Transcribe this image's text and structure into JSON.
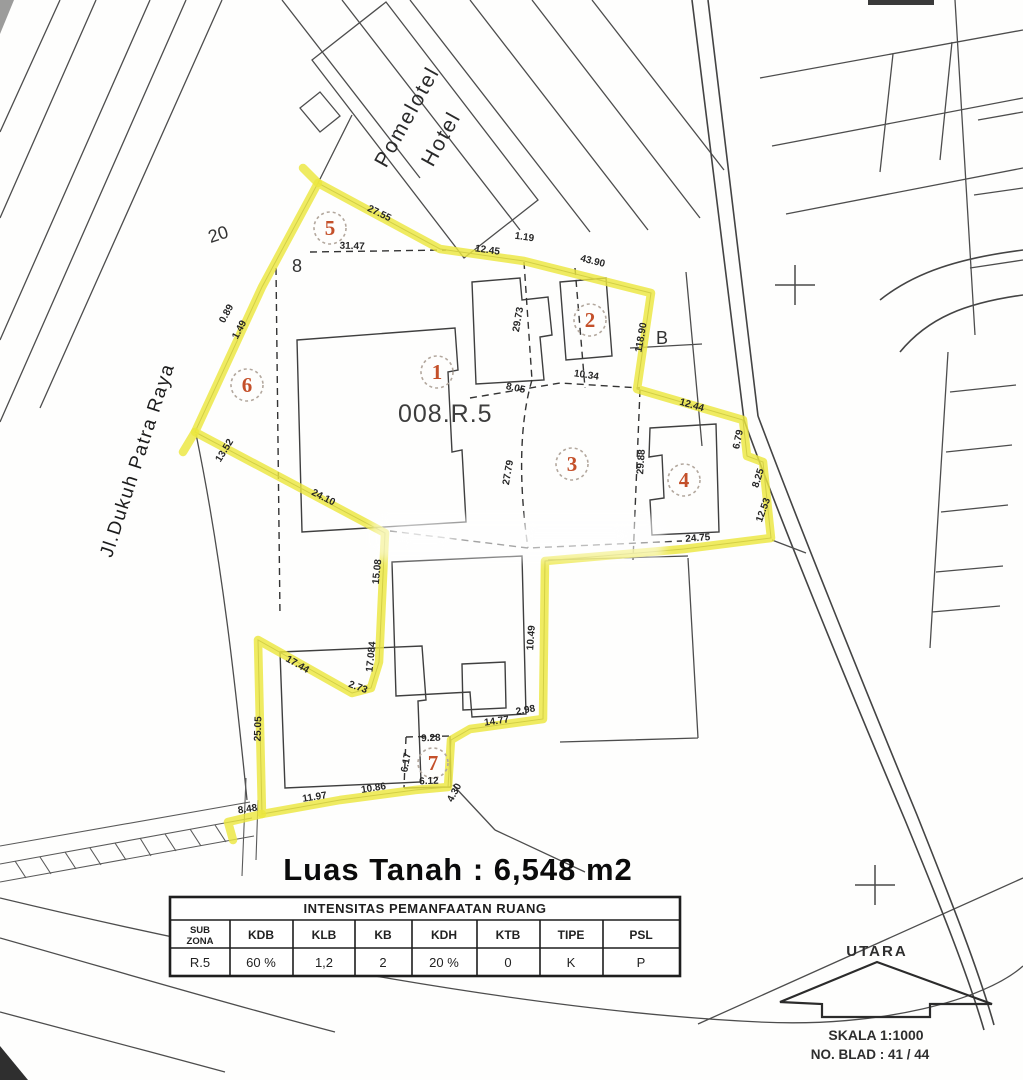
{
  "map": {
    "street_label": "Jl.Dukuh Patra Raya",
    "hotel_label_line1": "Pomelotel",
    "hotel_label_line2": "Hotel",
    "parcel_code": "008.R.5",
    "block_label": "B",
    "lot_number_20": "20",
    "lot_number_8": "8",
    "highlight_color": "#ece63e",
    "zone_number_color": "#c4502a",
    "zones": [
      "1",
      "2",
      "3",
      "4",
      "5",
      "6",
      "7"
    ],
    "dims": [
      "27.55",
      "31.47",
      "12.45",
      "1.19",
      "43.90",
      "118.90",
      "12.44",
      "6.79",
      "8.25",
      "12.53",
      "24.75",
      "29.88",
      "27.79",
      "8.05",
      "10.34",
      "29.73",
      "0.89",
      "1.49",
      "13.52",
      "24.10",
      "15.08",
      "17.084",
      "17.44",
      "2.73",
      "25.05",
      "10.49",
      "14.77",
      "2.98",
      "9.28",
      "6.17",
      "6.12",
      "4.30",
      "10.86",
      "11.97",
      "8.48"
    ]
  },
  "summary": {
    "area_label": "Luas Tanah : 6,548 m2"
  },
  "table": {
    "title": "INTENSITAS PEMANFAATAN RUANG",
    "subzona_line1": "SUB",
    "subzona_line2": "ZONA",
    "headers": [
      "KDB",
      "KLB",
      "KB",
      "KDH",
      "KTB",
      "TIPE",
      "PSL"
    ],
    "row": [
      "R.5",
      "60 %",
      "1,2",
      "2",
      "20 %",
      "0",
      "K",
      "P"
    ]
  },
  "compass": {
    "north_label": "UTARA",
    "scale_label": "SKALA  1:1000",
    "sheet_label": "NO. BLAD : 41 / 44"
  }
}
